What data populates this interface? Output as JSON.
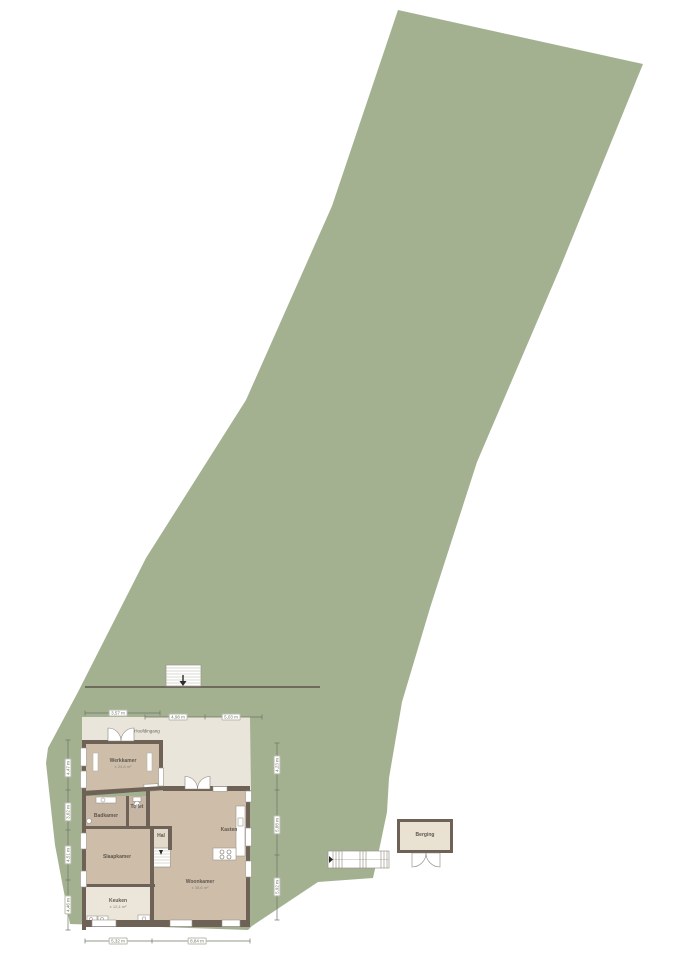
{
  "palette": {
    "plot_green": "#a3b190",
    "terrace": "#e9e5da",
    "wall": "#6e6156",
    "floor_main": "#cdbda9",
    "floor_wet": "#c6b6a3",
    "floor_light": "#ece6da",
    "floor_hall": "#e2d9ca",
    "outbuilding_floor": "#e9e1d2",
    "dimension_line": "#6f7465",
    "background": "#ffffff"
  },
  "annotations": {
    "entrance": "Hoofdingang"
  },
  "rooms": {
    "werkkamer": {
      "label": "Werkkamer",
      "area": "± 24,8 m²"
    },
    "badkamer": {
      "label": "Badkamer"
    },
    "toilet": {
      "label": "Toilet"
    },
    "slaapkamer": {
      "label": "Slaapkamer"
    },
    "hal": {
      "label": "Hal"
    },
    "keuken": {
      "label": "Keuken",
      "area": "± 12,4 m²"
    },
    "woonkamer": {
      "label": "Woonkamer",
      "area": "± 38,6 m²"
    },
    "kasten": {
      "label": "Kasten"
    },
    "berging": {
      "label": "Berging"
    }
  },
  "dimensions": {
    "top": [
      "3,57 m",
      "4,98 m",
      "5,03 m"
    ],
    "left": [
      "4,47 m",
      "3,62 m",
      "4,51 m",
      "4,46 m"
    ],
    "right": [
      "4,23 m",
      "5,88 m",
      "5,92 m"
    ],
    "bottom": [
      "5,32 m",
      "8,84 m"
    ]
  }
}
